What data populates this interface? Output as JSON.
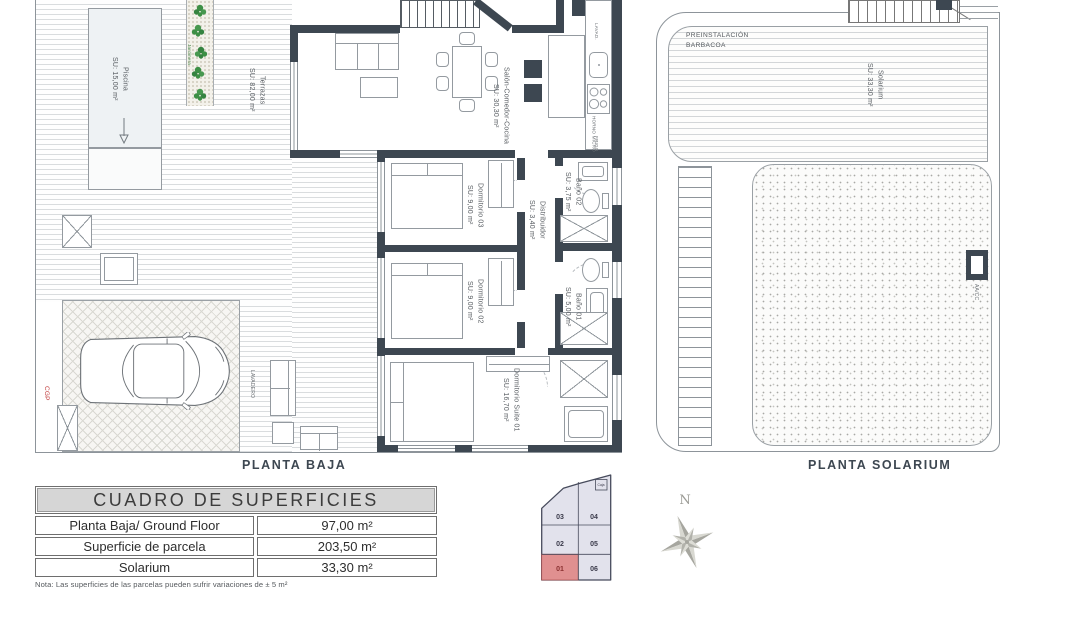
{
  "ground_floor": {
    "title": "PLANTA BAJA",
    "piscina_name": "Piscina",
    "piscina_area": "SU: 15,00 m²",
    "terraza_name": "Terrazas",
    "terraza_area": "SU: 82,00 m²",
    "jardinera_label": "Jardinera",
    "salon_name": "Salón-Comedor-Cocina",
    "salon_area": "SU: 30,30 m²",
    "dormitorio3_name": "Dormitorio 03",
    "dormitorio3_area": "SU: 9,00 m²",
    "dormitorio2_name": "Dormitorio 02",
    "dormitorio2_area": "SU: 9,00 m²",
    "suite_name": "Dormitorio Suite 01",
    "suite_area": "SU: 16,70 m²",
    "distribuidor_name": "Distribuidor",
    "distribuidor_area": "SU: 3,40 m²",
    "bano2_name": "Baño 02",
    "bano2_area": "SU: 3,75 m²",
    "bano1_name": "Baño 01",
    "bano1_area": "SU: 5,00 m²",
    "lavadero_label": "LAVADERO",
    "cgp_label": "CGP",
    "kitchen_lava": "LAVAD.",
    "kitchen_horno": "HORNO MICRO",
    "kitchen_frigo": "FRIGO"
  },
  "solarium_floor": {
    "title": "PLANTA SOLARIUM",
    "barbacoa_line1": "PREINSTALACIÓN",
    "barbacoa_line2": "BARBACOA",
    "solarium_name": "Solarium",
    "solarium_area": "SU: 33,30 m²",
    "aacc_label": "AA/CC"
  },
  "areas_table": {
    "title": "CUADRO DE SUPERFICIES",
    "rows": [
      {
        "label": "Planta Baja/ Ground Floor",
        "value": "97,00 m²"
      },
      {
        "label": "Superficie de parcela",
        "value": "203,50 m²"
      },
      {
        "label": "Solarium",
        "value": "33,30 m²"
      }
    ],
    "note": "Nota: Las superficies de las parcelas pueden sufrir variaciones de ± 5 m²"
  },
  "site_plan": {
    "lots": [
      "03",
      "04",
      "02",
      "05",
      "01",
      "06"
    ],
    "highlighted_lot": "01",
    "corner_label": "Caja"
  },
  "compass": {
    "north_label": "N"
  },
  "colors": {
    "wall": "#3d4751",
    "highlight_lot": "#e09090",
    "lot_fill": "#e2e2ec",
    "plant_green": "#3d8f45",
    "cgp_red": "#c03a3a"
  }
}
